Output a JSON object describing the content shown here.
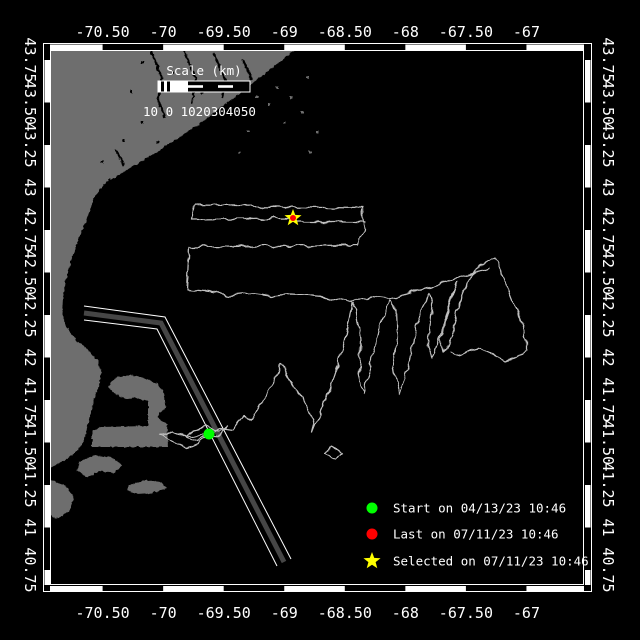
{
  "figure": {
    "background": "#000000",
    "kind": "glider-track-map"
  },
  "colors": {
    "land": "#6e6e6e",
    "sea": "#000000",
    "track": "#c0c0c0",
    "lane_fill": "#464646",
    "lane_edge": "#ffffff",
    "frame": "#ffffff",
    "text": "#ffffff",
    "start_marker": "#00ff00",
    "last_marker": "#ff0000",
    "selected_marker": "#ffff00"
  },
  "chart_data": {
    "type": "map-track",
    "x_axis": {
      "tick_labels": [
        "-70.50",
        "-70",
        "-69.50",
        "-69",
        "-68.50",
        "-68",
        "-67.50",
        "-67"
      ],
      "tick_values": [
        -70.5,
        -70,
        -69.5,
        -69,
        -68.5,
        -68,
        -67.5,
        -67
      ],
      "range_deg": [
        -70.93,
        -66.52
      ]
    },
    "y_axis": {
      "tick_labels": [
        "43.75",
        "43.50",
        "43.25",
        "43",
        "42.75",
        "42.50",
        "42.25",
        "42",
        "41.75",
        "41.50",
        "41.25",
        "41",
        "40.75"
      ],
      "tick_values": [
        43.75,
        43.5,
        43.25,
        43,
        42.75,
        42.5,
        42.25,
        42,
        41.75,
        41.5,
        41.25,
        41,
        40.75
      ],
      "range_deg": [
        40.69,
        43.81
      ]
    },
    "scale_bar": {
      "label": "Scale (km)",
      "numbers": "10 0 1020304050",
      "km_values": [
        10,
        0,
        10,
        20,
        30,
        40,
        50
      ]
    },
    "legend": [
      {
        "marker": "circle",
        "color": "#00ff00",
        "label": "Start on 04/13/23 10:46"
      },
      {
        "marker": "circle",
        "color": "#ff0000",
        "label": "Last on 07/11/23 10:46"
      },
      {
        "marker": "star",
        "color": "#ffff00",
        "label": "Selected on 07/11/23 10:46"
      }
    ],
    "markers": [
      {
        "id": "start",
        "px": [
          209,
          434
        ],
        "lon": -69.62,
        "lat": 41.55
      },
      {
        "id": "last",
        "px": [
          293,
          218
        ],
        "lon": -68.92,
        "lat": 42.82
      },
      {
        "id": "selected",
        "px": [
          293,
          218
        ],
        "lon": -68.92,
        "lat": 42.82
      }
    ],
    "layout": {
      "plot_px": [
        50,
        50,
        584,
        585
      ],
      "lon_origin": {
        "lon": -70.5,
        "x": 102.6,
        "px_per_deg": 121.1
      },
      "lat_origin": {
        "lat": 43.75,
        "y": 60,
        "px_per_deg": 170
      },
      "grid": false,
      "legend_position": "bottom-right-inside"
    },
    "track_px": {
      "knot": [
        [
          209,
          434
        ],
        [
          197,
          441
        ],
        [
          186,
          437
        ],
        [
          193,
          430
        ],
        [
          206,
          427
        ],
        [
          219,
          432
        ],
        [
          228,
          426
        ],
        [
          218,
          438
        ],
        [
          208,
          436
        ],
        [
          196,
          444
        ],
        [
          187,
          448
        ],
        [
          178,
          444
        ],
        [
          168,
          438
        ],
        [
          161,
          435
        ],
        [
          172,
          432
        ],
        [
          182,
          436
        ],
        [
          196,
          436
        ],
        [
          209,
          434
        ]
      ],
      "main": [
        [
          209,
          434
        ],
        [
          222,
          428
        ],
        [
          232,
          430
        ],
        [
          243,
          416
        ],
        [
          252,
          420
        ],
        [
          259,
          407
        ],
        [
          266,
          396
        ],
        [
          273,
          381
        ],
        [
          281,
          363
        ],
        [
          287,
          375
        ],
        [
          295,
          389
        ],
        [
          303,
          398
        ],
        [
          309,
          411
        ],
        [
          314,
          424
        ],
        [
          312,
          432
        ],
        [
          320,
          412
        ],
        [
          330,
          390
        ],
        [
          338,
          366
        ],
        [
          344,
          344
        ],
        [
          349,
          320
        ],
        [
          352,
          303
        ],
        [
          356,
          310
        ],
        [
          361,
          340
        ],
        [
          359,
          372
        ],
        [
          363,
          395
        ],
        [
          369,
          373
        ],
        [
          375,
          348
        ],
        [
          381,
          324
        ],
        [
          387,
          305
        ],
        [
          391,
          300
        ],
        [
          396,
          308
        ],
        [
          397,
          338
        ],
        [
          393,
          368
        ],
        [
          400,
          393
        ],
        [
          407,
          370
        ],
        [
          413,
          345
        ],
        [
          419,
          320
        ],
        [
          425,
          300
        ],
        [
          429,
          293
        ],
        [
          432,
          304
        ],
        [
          430,
          326
        ],
        [
          427,
          344
        ],
        [
          432,
          359
        ],
        [
          439,
          341
        ],
        [
          445,
          320
        ],
        [
          451,
          300
        ],
        [
          457,
          282
        ],
        [
          452,
          300
        ],
        [
          446,
          321
        ],
        [
          441,
          339
        ],
        [
          444,
          352
        ],
        [
          452,
          334
        ],
        [
          457,
          314
        ],
        [
          462,
          295
        ],
        [
          468,
          280
        ],
        [
          477,
          269
        ],
        [
          487,
          262
        ],
        [
          495,
          258
        ],
        [
          502,
          274
        ],
        [
          509,
          292
        ],
        [
          516,
          310
        ],
        [
          522,
          326
        ],
        [
          527,
          340
        ],
        [
          527,
          350
        ],
        [
          518,
          357
        ],
        [
          505,
          361
        ],
        [
          492,
          353
        ],
        [
          481,
          348
        ],
        [
          470,
          351
        ],
        [
          460,
          356
        ],
        [
          450,
          352
        ]
      ],
      "return_serpentine": [
        [
          490,
          268
        ],
        [
          470,
          274
        ],
        [
          450,
          280
        ],
        [
          430,
          287
        ],
        [
          410,
          293
        ],
        [
          390,
          299
        ],
        [
          370,
          297
        ],
        [
          350,
          302
        ],
        [
          330,
          298
        ],
        [
          310,
          295
        ],
        [
          290,
          294
        ],
        [
          270,
          296
        ],
        [
          250,
          293
        ],
        [
          230,
          295
        ],
        [
          210,
          292
        ],
        [
          187,
          290
        ],
        [
          189,
          247
        ],
        [
          359,
          245
        ],
        [
          364,
          228
        ],
        [
          363,
          208
        ],
        [
          194,
          206
        ],
        [
          191,
          219
        ],
        [
          293,
          218
        ]
      ],
      "stub": [
        [
          295,
          222
        ],
        [
          366,
          222
        ]
      ],
      "curl": [
        [
          330,
          447
        ],
        [
          341,
          452
        ],
        [
          335,
          459
        ],
        [
          326,
          453
        ],
        [
          330,
          447
        ]
      ]
    },
    "land_px": {
      "mainland": [
        [
          50,
          47
        ],
        [
          298,
          47
        ],
        [
          280,
          62
        ],
        [
          262,
          76
        ],
        [
          244,
          90
        ],
        [
          228,
          102
        ],
        [
          212,
          114
        ],
        [
          196,
          126
        ],
        [
          178,
          138
        ],
        [
          160,
          150
        ],
        [
          140,
          162
        ],
        [
          120,
          174
        ],
        [
          104,
          184
        ],
        [
          95,
          196
        ],
        [
          90,
          210
        ],
        [
          84,
          226
        ],
        [
          77,
          243
        ],
        [
          71,
          261
        ],
        [
          66,
          280
        ],
        [
          63,
          298
        ],
        [
          62,
          314
        ],
        [
          67,
          328
        ],
        [
          76,
          340
        ],
        [
          88,
          350
        ],
        [
          97,
          360
        ],
        [
          101,
          372
        ],
        [
          99,
          386
        ],
        [
          94,
          400
        ],
        [
          90,
          415
        ],
        [
          87,
          428
        ],
        [
          84,
          440
        ],
        [
          78,
          450
        ],
        [
          68,
          458
        ],
        [
          58,
          464
        ],
        [
          50,
          468
        ]
      ],
      "cape_cod": [
        [
          92,
          447
        ],
        [
          92,
          431
        ],
        [
          100,
          427
        ],
        [
          148,
          426
        ],
        [
          148,
          402
        ],
        [
          138,
          398
        ],
        [
          126,
          399
        ],
        [
          114,
          394
        ],
        [
          108,
          386
        ],
        [
          116,
          378
        ],
        [
          130,
          375
        ],
        [
          145,
          378
        ],
        [
          157,
          384
        ],
        [
          164,
          393
        ],
        [
          166,
          408
        ],
        [
          160,
          412
        ],
        [
          157,
          417
        ],
        [
          162,
          421
        ],
        [
          167,
          424
        ],
        [
          168,
          447
        ]
      ],
      "marthas_vineyard": [
        [
          80,
          461
        ],
        [
          96,
          455
        ],
        [
          112,
          458
        ],
        [
          123,
          465
        ],
        [
          114,
          473
        ],
        [
          99,
          471
        ],
        [
          87,
          478
        ],
        [
          77,
          470
        ]
      ],
      "nantucket": [
        [
          129,
          485
        ],
        [
          145,
          480
        ],
        [
          161,
          482
        ],
        [
          167,
          488
        ],
        [
          152,
          493
        ],
        [
          137,
          494
        ],
        [
          127,
          490
        ]
      ],
      "south_island": [
        [
          50,
          480
        ],
        [
          66,
          486
        ],
        [
          74,
          497
        ],
        [
          69,
          512
        ],
        [
          56,
          519
        ],
        [
          50,
          514
        ]
      ],
      "rivers": [
        [
          [
            150,
            48
          ],
          [
            162,
            78
          ],
          [
            158,
            100
          ],
          [
            165,
            118
          ]
        ],
        [
          [
            184,
            50
          ],
          [
            196,
            80
          ],
          [
            192,
            104
          ]
        ],
        [
          [
            214,
            54
          ],
          [
            226,
            82
          ],
          [
            222,
            98
          ]
        ],
        [
          [
            243,
            60
          ],
          [
            252,
            80
          ]
        ],
        [
          [
            116,
            150
          ],
          [
            124,
            166
          ]
        ]
      ],
      "sea_dots": [
        [
          262,
          70
        ],
        [
          276,
          86
        ],
        [
          290,
          96
        ],
        [
          301,
          111
        ],
        [
          283,
          121
        ],
        [
          268,
          103
        ],
        [
          256,
          96
        ],
        [
          306,
          76
        ],
        [
          316,
          131
        ],
        [
          309,
          151
        ],
        [
          247,
          130
        ],
        [
          238,
          152
        ]
      ],
      "land_dots": [
        [
          130,
          90
        ],
        [
          141,
          121
        ],
        [
          156,
          141
        ],
        [
          101,
          161
        ],
        [
          91,
          231
        ],
        [
          76,
          301
        ],
        [
          141,
          61
        ],
        [
          171,
          71
        ],
        [
          201,
          91
        ],
        [
          231,
          81
        ],
        [
          122,
          139
        ],
        [
          108,
          178
        ]
      ]
    },
    "lane_px": {
      "core": [
        [
          84,
          313
        ],
        [
          161,
          323
        ],
        [
          284,
          562
        ]
      ],
      "edge_a": [
        [
          84,
          306
        ],
        [
          165,
          317
        ],
        [
          291,
          559
        ]
      ],
      "edge_b": [
        [
          84,
          320
        ],
        [
          157,
          329
        ],
        [
          277,
          566
        ]
      ]
    }
  }
}
